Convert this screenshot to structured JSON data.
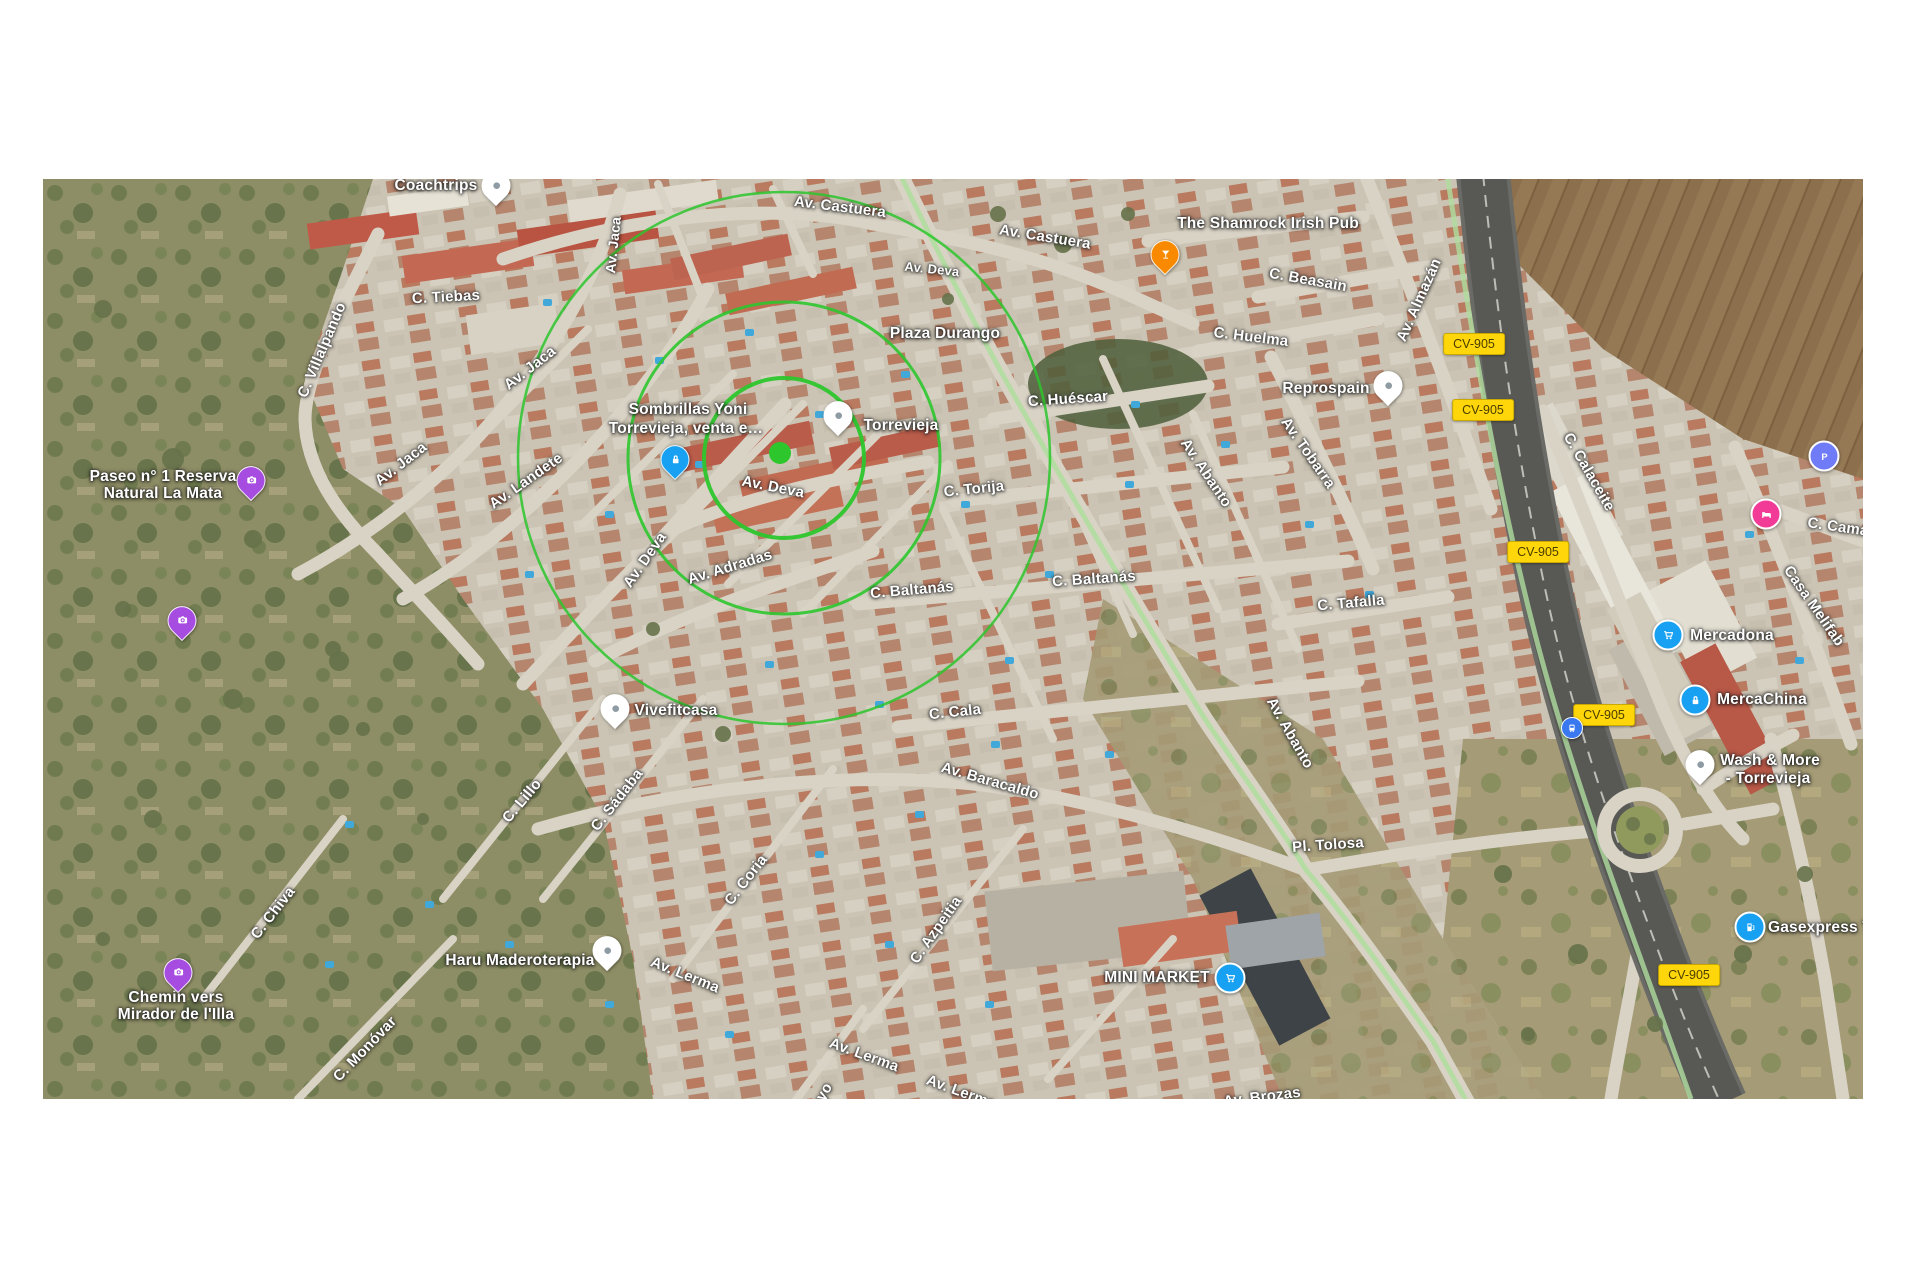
{
  "map": {
    "overlay": {
      "cx": 741,
      "cy": 279,
      "radii": [
        80,
        156,
        266
      ],
      "dot_x": 737,
      "dot_y": 274,
      "dot_r": 11,
      "color": "#2DC62D"
    },
    "street_labels": [
      {
        "name": "street-label-av-castuera-1",
        "text": "Av. Castuera",
        "x": 797,
        "y": 28,
        "rot": 7,
        "size": 15
      },
      {
        "name": "street-label-av-castuera-2",
        "text": "Av. Castuera",
        "x": 1002,
        "y": 58,
        "rot": 9,
        "size": 15
      },
      {
        "name": "street-label-av-deva-top",
        "text": "Av. Deva",
        "x": 889,
        "y": 90,
        "rot": 6,
        "size": 13
      },
      {
        "name": "street-label-c-beasain",
        "text": "C. Beasain",
        "x": 1265,
        "y": 101,
        "rot": 10,
        "size": 15
      },
      {
        "name": "street-label-c-huelma",
        "text": "C. Huelma",
        "x": 1208,
        "y": 158,
        "rot": 7,
        "size": 15
      },
      {
        "name": "street-label-av-almazan",
        "text": "Av. Almazán",
        "x": 1376,
        "y": 121,
        "rot": -66,
        "size": 15
      },
      {
        "name": "street-label-c-tiebas",
        "text": "C. Tiebas",
        "x": 403,
        "y": 118,
        "rot": -3,
        "size": 15
      },
      {
        "name": "street-label-c-villalpando",
        "text": "C. Villalpando",
        "x": 279,
        "y": 171,
        "rot": -67,
        "size": 15
      },
      {
        "name": "street-label-av-jaca-1",
        "text": "Av. Jaca",
        "x": 570,
        "y": 66,
        "rot": -84,
        "size": 14
      },
      {
        "name": "street-label-av-jaca-2",
        "text": "Av. Jaca",
        "x": 487,
        "y": 189,
        "rot": -38,
        "size": 15
      },
      {
        "name": "street-label-av-jaca-3",
        "text": "Av. Jaca",
        "x": 358,
        "y": 285,
        "rot": -38,
        "size": 15
      },
      {
        "name": "street-label-av-landete",
        "text": "Av. Landete",
        "x": 483,
        "y": 302,
        "rot": -35,
        "size": 15
      },
      {
        "name": "street-label-c-huescar",
        "text": "C. Huéscar",
        "x": 1025,
        "y": 220,
        "rot": -4,
        "size": 15
      },
      {
        "name": "street-label-av-tobarra",
        "text": "Av. Tobarra",
        "x": 1265,
        "y": 274,
        "rot": 55,
        "size": 15
      },
      {
        "name": "street-label-c-torija",
        "text": "C. Torija",
        "x": 931,
        "y": 310,
        "rot": -6,
        "size": 15
      },
      {
        "name": "street-label-c-tafalla",
        "text": "C. Tafalla",
        "x": 1308,
        "y": 424,
        "rot": -5,
        "size": 15
      },
      {
        "name": "street-label-av-abanto-1",
        "text": "Av. Abanto",
        "x": 1163,
        "y": 294,
        "rot": 56,
        "size": 15
      },
      {
        "name": "street-label-av-abanto-2",
        "text": "Av. Abanto",
        "x": 1247,
        "y": 554,
        "rot": 60,
        "size": 15
      },
      {
        "name": "street-label-av-deva-center",
        "text": "Av. Deva",
        "x": 730,
        "y": 308,
        "rot": 11,
        "size": 15
      },
      {
        "name": "street-label-av-deva-diag",
        "text": "Av. Deva",
        "x": 602,
        "y": 381,
        "rot": -55,
        "size": 15
      },
      {
        "name": "street-label-av-adradas",
        "text": "Av. Adradas",
        "x": 687,
        "y": 388,
        "rot": -17,
        "size": 15
      },
      {
        "name": "street-label-c-baltanas-left",
        "text": "C. Baltanás",
        "x": 869,
        "y": 411,
        "rot": -5,
        "size": 15
      },
      {
        "name": "street-label-c-baltanas-right",
        "text": "C. Baltanás",
        "x": 1051,
        "y": 400,
        "rot": -4,
        "size": 15
      },
      {
        "name": "street-label-c-cala",
        "text": "C. Cala",
        "x": 912,
        "y": 533,
        "rot": -6,
        "size": 15
      },
      {
        "name": "street-label-av-baracaldo",
        "text": "Av. Baracaldo",
        "x": 947,
        "y": 602,
        "rot": 16,
        "size": 15
      },
      {
        "name": "street-label-pl-tolosa",
        "text": "Pl. Tolosa",
        "x": 1285,
        "y": 666,
        "rot": -4,
        "size": 15
      },
      {
        "name": "street-label-c-calaceite",
        "text": "C. Calaceite",
        "x": 1546,
        "y": 293,
        "rot": 60,
        "size": 15
      },
      {
        "name": "street-label-casa-melifab",
        "text": "Casa Melifab",
        "x": 1771,
        "y": 427,
        "rot": 55,
        "size": 15
      },
      {
        "name": "street-label-c-cama",
        "text": "C. Cama",
        "x": 1795,
        "y": 348,
        "rot": 8,
        "size": 15
      },
      {
        "name": "street-label-c-chiva",
        "text": "C. Chiva",
        "x": 230,
        "y": 734,
        "rot": -52,
        "size": 15
      },
      {
        "name": "street-label-c-monovar",
        "text": "C. Monóvar",
        "x": 322,
        "y": 870,
        "rot": -46,
        "size": 15
      },
      {
        "name": "street-label-c-lillo",
        "text": "C. Lillo",
        "x": 479,
        "y": 622,
        "rot": -50,
        "size": 15
      },
      {
        "name": "street-label-c-sadaba",
        "text": "C. Sádaba",
        "x": 574,
        "y": 621,
        "rot": -52,
        "size": 15
      },
      {
        "name": "street-label-c-coria",
        "text": "C. Coria",
        "x": 703,
        "y": 701,
        "rot": -52,
        "size": 15
      },
      {
        "name": "street-label-c-azpeitia",
        "text": "C. Azpeitia",
        "x": 893,
        "y": 751,
        "rot": -55,
        "size": 15
      },
      {
        "name": "street-label-av-lerma-1",
        "text": "Av. Lerma",
        "x": 642,
        "y": 796,
        "rot": 22,
        "size": 15
      },
      {
        "name": "street-label-av-lerma-2",
        "text": "Av. Lerma",
        "x": 821,
        "y": 876,
        "rot": 20,
        "size": 15
      },
      {
        "name": "street-label-av-lerma-3",
        "text": "Av. Lerma",
        "x": 918,
        "y": 913,
        "rot": 20,
        "size": 15
      },
      {
        "name": "street-label-av-brozas",
        "text": "Av. Brozas",
        "x": 1219,
        "y": 918,
        "rot": -7,
        "size": 15
      },
      {
        "name": "street-label-fragment-oyo",
        "text": "oyo",
        "x": 779,
        "y": 917,
        "rot": -60,
        "size": 15
      }
    ],
    "poi_labels": [
      {
        "name": "poi-label-coachtrips",
        "text": "Coachtrips",
        "x": 393,
        "y": 7
      },
      {
        "name": "poi-label-shamrock",
        "text": "The Shamrock Irish Pub",
        "x": 1225,
        "y": 45
      },
      {
        "name": "poi-label-sombrillas-line1",
        "text": "Sombrillas Yoni",
        "x": 645,
        "y": 231
      },
      {
        "name": "poi-label-sombrillas-line2",
        "text": "Torrevieja, venta e…",
        "x": 643,
        "y": 250
      },
      {
        "name": "poi-label-torrevieja",
        "text": "Torrevieja",
        "x": 858,
        "y": 247
      },
      {
        "name": "poi-label-plaza-durango",
        "text": "Plaza Durango",
        "x": 902,
        "y": 155
      },
      {
        "name": "poi-label-reprospain",
        "text": "Reprospain",
        "x": 1283,
        "y": 210
      },
      {
        "name": "poi-label-vivefitcasa",
        "text": "Vivefitcasa",
        "x": 633,
        "y": 532
      },
      {
        "name": "poi-label-haru",
        "text": "Haru Maderoterapia",
        "x": 477,
        "y": 782
      },
      {
        "name": "poi-label-mercadona",
        "text": "Mercadona",
        "x": 1689,
        "y": 457
      },
      {
        "name": "poi-label-mercachina",
        "text": "MercaChina",
        "x": 1719,
        "y": 521
      },
      {
        "name": "poi-label-wash-line1",
        "text": "Wash & More",
        "x": 1727,
        "y": 582
      },
      {
        "name": "poi-label-wash-line2",
        "text": "- Torrevieja",
        "x": 1725,
        "y": 600
      },
      {
        "name": "poi-label-gasexpress",
        "text": "Gasexpress T",
        "x": 1777,
        "y": 749
      },
      {
        "name": "poi-label-mini-market",
        "text": "MINI MARKET",
        "x": 1114,
        "y": 799
      },
      {
        "name": "poi-label-paseo-line1",
        "text": "Paseo n° 1 Reserva",
        "x": 120,
        "y": 298
      },
      {
        "name": "poi-label-paseo-line2",
        "text": "Natural La Mata",
        "x": 120,
        "y": 315
      },
      {
        "name": "poi-label-chemin-line1",
        "text": "Chemin vers",
        "x": 133,
        "y": 819
      },
      {
        "name": "poi-label-chemin-line2",
        "text": "Mirador de l'Illa",
        "x": 133,
        "y": 836
      }
    ],
    "shields": [
      {
        "name": "route-shield-cv905-1",
        "text": "CV-905",
        "x": 1431,
        "y": 165
      },
      {
        "name": "route-shield-cv905-2",
        "text": "CV-905",
        "x": 1440,
        "y": 231
      },
      {
        "name": "route-shield-cv905-3",
        "text": "CV-905",
        "x": 1495,
        "y": 373
      },
      {
        "name": "route-shield-cv905-4",
        "text": "CV-905",
        "x": 1561,
        "y": 536
      },
      {
        "name": "route-shield-cv905-5",
        "text": "CV-905",
        "x": 1646,
        "y": 796
      }
    ],
    "markers": [
      {
        "name": "coachtrips-pin",
        "kind": "whitepin",
        "icon": "dot-icon",
        "color": "#ffffff",
        "x": 453,
        "y": 9
      },
      {
        "name": "shamrock-bar-pin",
        "kind": "pin",
        "icon": "cocktail-icon",
        "color": "#F98A00",
        "x": 1122,
        "y": 78
      },
      {
        "name": "photo-pin-paseo",
        "kind": "pin",
        "icon": "camera-icon",
        "color": "#A64CE0",
        "x": 208,
        "y": 304
      },
      {
        "name": "photo-pin-mid",
        "kind": "pin",
        "icon": "camera-icon",
        "color": "#A64CE0",
        "x": 139,
        "y": 444
      },
      {
        "name": "photo-pin-chemin",
        "kind": "pin",
        "icon": "camera-icon",
        "color": "#A64CE0",
        "x": 135,
        "y": 796
      },
      {
        "name": "sombrillas-shop-pin",
        "kind": "pin",
        "icon": "lock-icon",
        "color": "#18A1F2",
        "x": 632,
        "y": 283
      },
      {
        "name": "torrevieja-pin",
        "kind": "whitepin",
        "icon": "dot-icon",
        "color": "#ffffff",
        "x": 795,
        "y": 239
      },
      {
        "name": "reprospain-pin",
        "kind": "whitepin",
        "icon": "dot-icon",
        "color": "#ffffff",
        "x": 1345,
        "y": 209
      },
      {
        "name": "vivefitcasa-pin",
        "kind": "whitepin",
        "icon": "dot-icon",
        "color": "#ffffff",
        "x": 572,
        "y": 532
      },
      {
        "name": "haru-pin",
        "kind": "whitepin",
        "icon": "dot-icon",
        "color": "#ffffff",
        "x": 564,
        "y": 774
      },
      {
        "name": "mercadona-cart-pin",
        "kind": "circle",
        "icon": "cart-icon",
        "color": "#18A1F2",
        "x": 1625,
        "y": 456
      },
      {
        "name": "mercachina-shop-pin",
        "kind": "circle",
        "icon": "lock-icon",
        "color": "#18A1F2",
        "x": 1652,
        "y": 521
      },
      {
        "name": "wash-more-pin",
        "kind": "whitepin",
        "icon": "dot-icon",
        "color": "#ffffff",
        "x": 1657,
        "y": 588
      },
      {
        "name": "gasexpress-fuel-pin",
        "kind": "circle",
        "icon": "fuel-icon",
        "color": "#18A1F2",
        "x": 1707,
        "y": 748
      },
      {
        "name": "mini-market-cart-pin",
        "kind": "circle",
        "icon": "cart-icon",
        "color": "#18A1F2",
        "x": 1187,
        "y": 799
      },
      {
        "name": "parking-pin",
        "kind": "circle",
        "icon": "p-icon",
        "color": "#6F7BF7",
        "x": 1781,
        "y": 277
      },
      {
        "name": "hotel-pin",
        "kind": "circle",
        "icon": "bed-icon",
        "color": "#F23B96",
        "x": 1723,
        "y": 335
      },
      {
        "name": "bus-stop-pin",
        "kind": "circle-sm",
        "icon": "bus-icon",
        "color": "#3A78F0",
        "x": 1529,
        "y": 549
      }
    ]
  }
}
